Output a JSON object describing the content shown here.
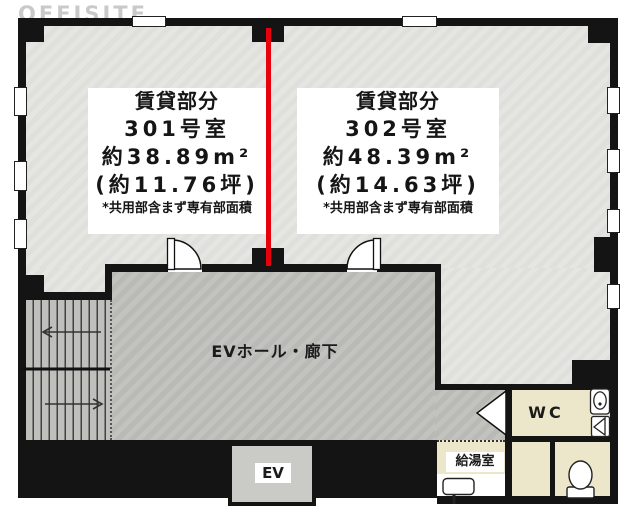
{
  "watermark": "OFFISITE",
  "units": [
    {
      "section": "賃貸部分",
      "room": "301号室",
      "area_m2": "約38.89m²",
      "area_tsubo": "(約11.76坪)",
      "note": "*共用部含まず専有部面積"
    },
    {
      "section": "賃貸部分",
      "room": "302号室",
      "area_m2": "約48.39m²",
      "area_tsubo": "(約14.63坪)",
      "note": "*共用部含まず専有部面積"
    }
  ],
  "labels": {
    "corridor": "EVホール・廊下",
    "elevator": "EV",
    "toilet": "WC",
    "kitchenette": "給湯室"
  },
  "colors": {
    "wall": "#141414",
    "floor": "#e4e4e0",
    "corridor": "#bfbfbc",
    "service": "#ece7cb",
    "ev": "#cacac7",
    "accent": "#e8000d",
    "watermark": "#c9c9c9"
  }
}
